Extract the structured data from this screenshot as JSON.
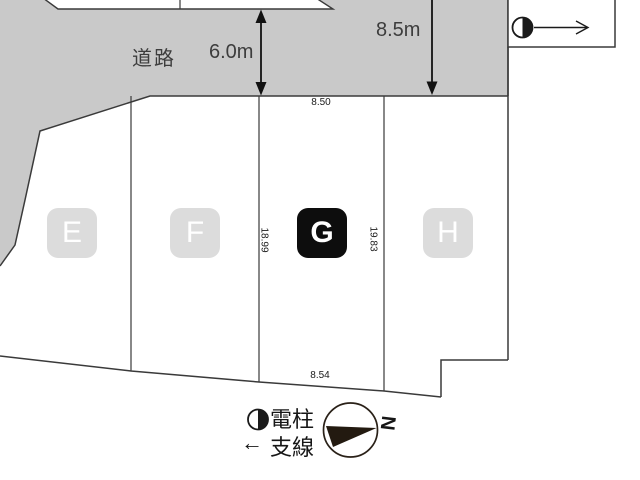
{
  "road": {
    "label": "道路",
    "width_label": "6.0m",
    "setback_label": "8.5m"
  },
  "plots": [
    {
      "label": "E",
      "highlighted": false
    },
    {
      "label": "F",
      "highlighted": false
    },
    {
      "label": "G",
      "highlighted": true,
      "front_width": "8.50",
      "left_depth": "18.99",
      "right_depth": "19.83",
      "rear_width": "8.54"
    },
    {
      "label": "H",
      "highlighted": false
    }
  ],
  "legend": {
    "pole_symbol": "half-filled-circle",
    "pole_label": "電柱",
    "guy_symbol": "←",
    "guy_label": "支線"
  },
  "compass": {
    "north_label": "N"
  },
  "colors": {
    "road_fill": "#c9c9c9",
    "outline": "#3a3a3a",
    "badge_fill": "#dcdcdc",
    "badge_active_fill": "#0d0d0d",
    "badge_text": "#ffffff",
    "label_text": "#3d3d3d",
    "symbol_ink": "#1a1a1a"
  }
}
